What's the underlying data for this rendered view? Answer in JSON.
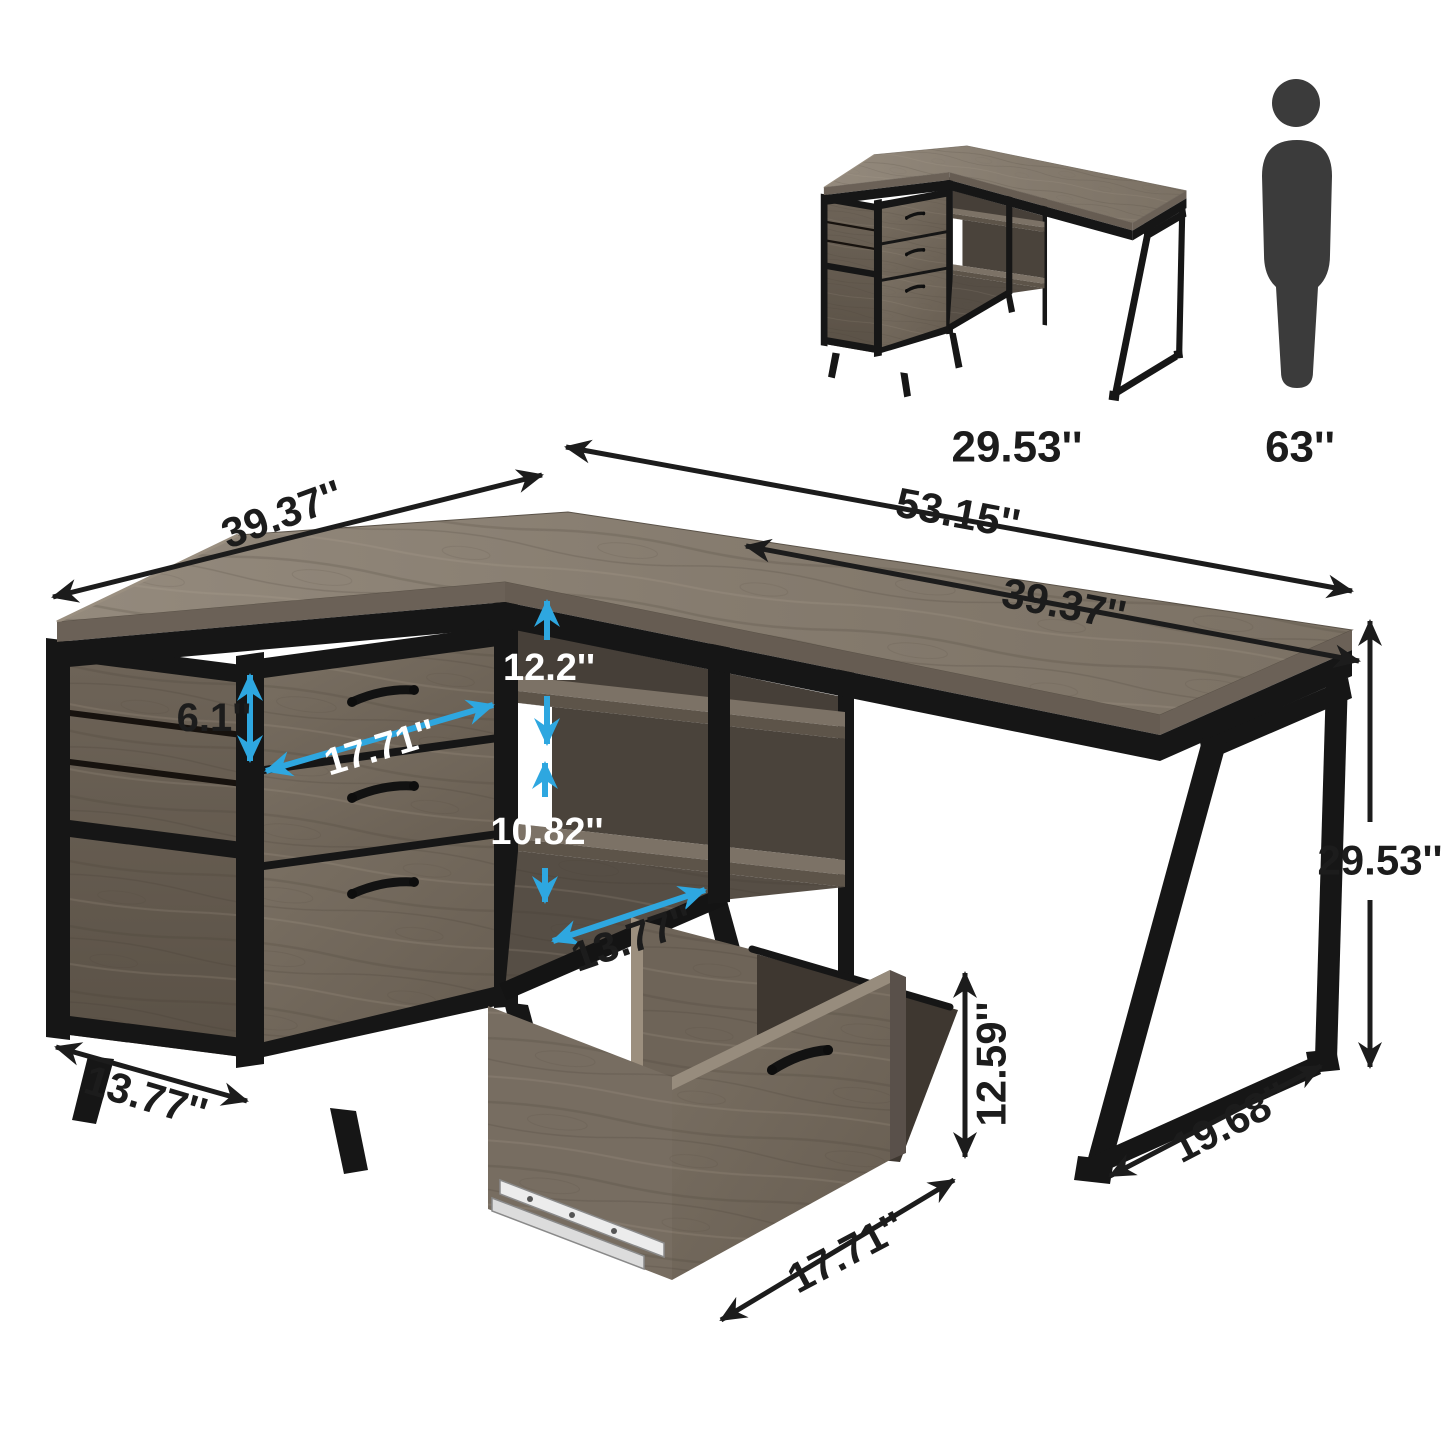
{
  "thumbnail": {
    "desk_label": "29.53''",
    "person_height_label": "63''"
  },
  "main_dimensions": {
    "total_width": "53.15''",
    "right_desktop_width": "39.37''",
    "left_wing_width": "39.37''",
    "top_drawer_height": "6.1''",
    "drawer_width": "17.71''",
    "upper_cubby_height": "12.2''",
    "lower_cubby_height": "10.82''",
    "shelf_depth": "13.77''",
    "cabinet_depth": "13.77''",
    "desk_height": "29.53''",
    "leg_base_depth": "19.68''",
    "file_drawer_height": "12.59''",
    "file_drawer_depth": "17.71''"
  },
  "icons": {
    "person": "person-silhouette-icon"
  },
  "colors": {
    "background": "#ffffff",
    "blue_arrow": "#2ea7e0",
    "black_arrow": "#1c1c1c",
    "white_label": "#ffffff",
    "wood_light": "#948a7d",
    "wood_mid": "#756b5f",
    "wood_dark": "#4a433b",
    "metal_black": "#161616",
    "person_icon": "#3b3b3b"
  }
}
